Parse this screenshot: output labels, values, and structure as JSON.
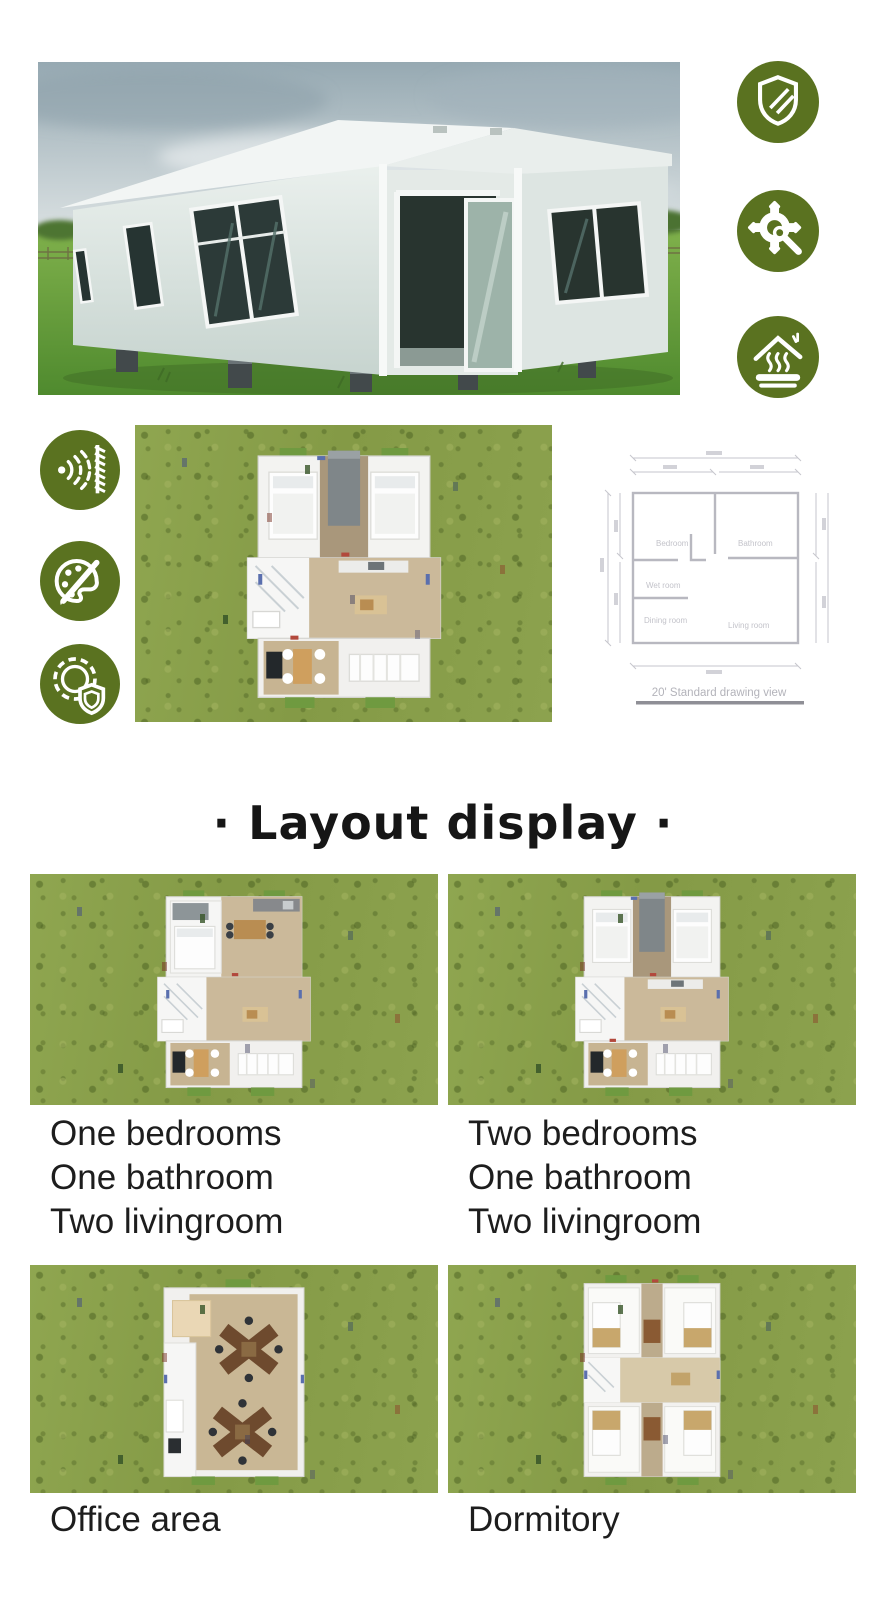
{
  "colors": {
    "icon_green": "#5a7220",
    "grass_base": "#8aa04c",
    "heading_text": "#161616",
    "label_text": "#1d1d1d"
  },
  "hero": {
    "image_name": "expandable-container-house-photo",
    "badge_icons": [
      "shield-stripes-icon",
      "gear-wrench-icon",
      "insulated-roof-icon"
    ]
  },
  "features": {
    "icons": [
      "soundproofing-icon",
      "paint-palette-icon",
      "gear-shield-icon"
    ],
    "floorplan_image_name": "two-bedroom-3d-floorplan-on-grass",
    "drawing": {
      "room_labels": [
        "Bedroom",
        "Bathroom",
        "Wet room",
        "Dining room",
        "Living room"
      ],
      "caption": "20' Standard drawing view"
    }
  },
  "layout_section": {
    "heading": "· Layout display ·",
    "cards": [
      {
        "image_name": "one-bedroom-floorplan",
        "label_lines": [
          "One bedrooms",
          "One bathroom",
          "Two livingroom"
        ]
      },
      {
        "image_name": "two-bedroom-floorplan",
        "label_lines": [
          "Two bedrooms",
          "One bathroom",
          "Two livingroom"
        ]
      },
      {
        "image_name": "office-area-floorplan",
        "label_lines": [
          "Office area"
        ]
      },
      {
        "image_name": "dormitory-floorplan",
        "label_lines": [
          "Dormitory"
        ]
      }
    ]
  }
}
